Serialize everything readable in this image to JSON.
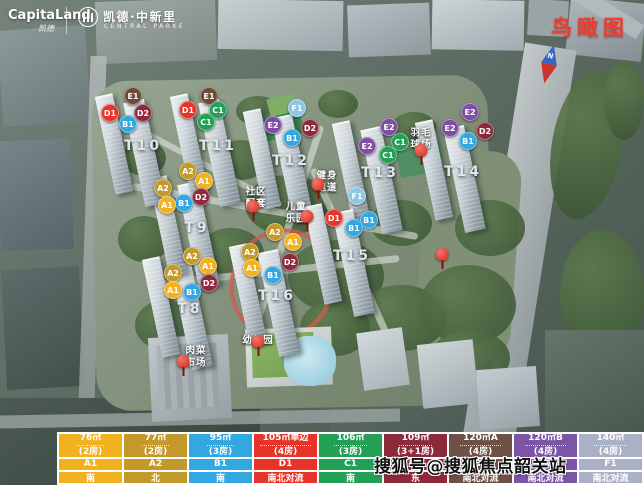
{
  "header": {
    "capitaland": "CapitaLand",
    "capitaland_script": "凯德",
    "project_name": "凯德·中新里",
    "project_sub": "CENTRAL PARKE"
  },
  "map": {
    "view_label": "鸟瞰图",
    "compass_label": "N",
    "towers": [
      {
        "label": "T8",
        "x": 190,
        "y": 309
      },
      {
        "label": "T9",
        "x": 197,
        "y": 228
      },
      {
        "label": "T10",
        "x": 143,
        "y": 146
      },
      {
        "label": "T11",
        "x": 218,
        "y": 146
      },
      {
        "label": "T12",
        "x": 291,
        "y": 161
      },
      {
        "label": "T13",
        "x": 380,
        "y": 173
      },
      {
        "label": "T14",
        "x": 463,
        "y": 172
      },
      {
        "label": "T15",
        "x": 352,
        "y": 256
      },
      {
        "label": "T16",
        "x": 277,
        "y": 296
      }
    ],
    "badges": [
      {
        "type": "E1",
        "x": 133,
        "y": 96
      },
      {
        "type": "D1",
        "x": 110,
        "y": 113
      },
      {
        "type": "D2",
        "x": 143,
        "y": 113
      },
      {
        "type": "B1",
        "x": 128,
        "y": 124
      },
      {
        "type": "E1",
        "x": 209,
        "y": 96
      },
      {
        "type": "D1",
        "x": 188,
        "y": 110
      },
      {
        "type": "C1",
        "x": 218,
        "y": 110
      },
      {
        "type": "C1",
        "x": 206,
        "y": 122
      },
      {
        "type": "F1",
        "x": 297,
        "y": 108
      },
      {
        "type": "E2",
        "x": 273,
        "y": 125
      },
      {
        "type": "D2",
        "x": 310,
        "y": 128
      },
      {
        "type": "B1",
        "x": 292,
        "y": 138
      },
      {
        "type": "E2",
        "x": 389,
        "y": 127
      },
      {
        "type": "E2",
        "x": 367,
        "y": 146
      },
      {
        "type": "C1",
        "x": 400,
        "y": 142
      },
      {
        "type": "C1",
        "x": 388,
        "y": 155
      },
      {
        "type": "E2",
        "x": 470,
        "y": 112
      },
      {
        "type": "E2",
        "x": 450,
        "y": 128
      },
      {
        "type": "D2",
        "x": 485,
        "y": 131
      },
      {
        "type": "B1",
        "x": 468,
        "y": 141
      },
      {
        "type": "A2",
        "x": 188,
        "y": 171
      },
      {
        "type": "A1",
        "x": 204,
        "y": 181
      },
      {
        "type": "A2",
        "x": 163,
        "y": 188
      },
      {
        "type": "D2",
        "x": 201,
        "y": 197
      },
      {
        "type": "B1",
        "x": 184,
        "y": 203
      },
      {
        "type": "A1",
        "x": 167,
        "y": 205
      },
      {
        "type": "F1",
        "x": 357,
        "y": 196
      },
      {
        "type": "D1",
        "x": 334,
        "y": 218
      },
      {
        "type": "B1",
        "x": 369,
        "y": 220
      },
      {
        "type": "B1",
        "x": 354,
        "y": 228
      },
      {
        "type": "A2",
        "x": 275,
        "y": 232
      },
      {
        "type": "A1",
        "x": 293,
        "y": 242
      },
      {
        "type": "A2",
        "x": 250,
        "y": 252
      },
      {
        "type": "D2",
        "x": 290,
        "y": 262
      },
      {
        "type": "A1",
        "x": 252,
        "y": 268
      },
      {
        "type": "B1",
        "x": 273,
        "y": 275
      },
      {
        "type": "A2",
        "x": 192,
        "y": 256
      },
      {
        "type": "A1",
        "x": 208,
        "y": 266
      },
      {
        "type": "A2",
        "x": 173,
        "y": 273
      },
      {
        "type": "D2",
        "x": 209,
        "y": 283
      },
      {
        "type": "A1",
        "x": 173,
        "y": 290
      },
      {
        "type": "B1",
        "x": 192,
        "y": 292
      }
    ],
    "facilities": [
      {
        "key": "community-amenities",
        "lines": [
          "社区",
          "配套"
        ],
        "x": 256,
        "y": 199
      },
      {
        "key": "children-playground",
        "lines": [
          "儿童",
          "乐园"
        ],
        "x": 296,
        "y": 214
      },
      {
        "key": "fitness-track",
        "lines": [
          "健身",
          "跑道"
        ],
        "x": 327,
        "y": 183
      },
      {
        "key": "badminton-court",
        "lines": [
          "羽毛",
          "球场"
        ],
        "x": 421,
        "y": 140
      },
      {
        "key": "wet-market",
        "lines": [
          "肉菜",
          "市场"
        ],
        "x": 196,
        "y": 358
      },
      {
        "key": "kindergarten",
        "lines": [
          "幼儿园"
        ],
        "x": 258,
        "y": 341
      }
    ],
    "pins": [
      {
        "x": 253,
        "y": 222
      },
      {
        "x": 318,
        "y": 200
      },
      {
        "x": 307,
        "y": 232
      },
      {
        "x": 421,
        "y": 166
      },
      {
        "x": 442,
        "y": 270
      },
      {
        "x": 258,
        "y": 357
      },
      {
        "x": 183,
        "y": 377
      }
    ]
  },
  "type_colors": {
    "A1": "#F2B11F",
    "A2": "#C2992A",
    "B1": "#33A7DF",
    "C1": "#23A055",
    "D1": "#E73328",
    "D2": "#8C2A3C",
    "E1": "#6E4A38",
    "E2": "#7E4FA0",
    "F1": "#8FC6E4"
  },
  "legend": {
    "columns": [
      {
        "color": "#F2B11F",
        "area": "76㎡",
        "rooms": "(2房)",
        "type": "A1",
        "orient": "南"
      },
      {
        "color": "#C2992A",
        "area": "77㎡",
        "rooms": "(2房)",
        "type": "A2",
        "orient": "北"
      },
      {
        "color": "#33A7DF",
        "area": "95㎡",
        "rooms": "(3房)",
        "type": "B1",
        "orient": "南"
      },
      {
        "color": "#E73328",
        "area": "105㎡单边",
        "rooms": "(4房)",
        "type": "D1",
        "orient": "南北对流"
      },
      {
        "color": "#23A055",
        "area": "106㎡",
        "rooms": "(3房)",
        "type": "C1",
        "orient": "南"
      },
      {
        "color": "#8C2A3C",
        "area": "109㎡",
        "rooms": "(3+1房)",
        "type": "D2",
        "orient": "东"
      },
      {
        "color": "#6E5144",
        "area": "120㎡A",
        "rooms": "(4房)",
        "type": "E1",
        "orient": "南北对流"
      },
      {
        "color": "#7C55A4",
        "area": "120㎡B",
        "rooms": "(4房)",
        "type": "E2",
        "orient": "南北对流"
      },
      {
        "color": "#AAB0C5",
        "area": "140㎡",
        "rooms": "(4房)",
        "type": "F1",
        "orient": "南北对流"
      }
    ]
  },
  "watermark": "搜狐号@搜狐焦点韶关站"
}
